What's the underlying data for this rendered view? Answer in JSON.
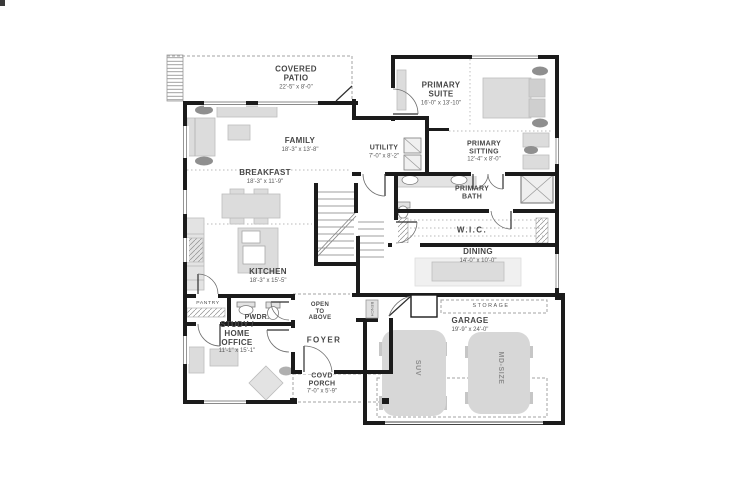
{
  "floor_plan": {
    "rooms": {
      "covered_patio": {
        "name": "COVERED PATIO",
        "dims": "22'-5\" x 8'-0\""
      },
      "family": {
        "name": "FAMILY",
        "dims": "18'-3\" x 13'-8\""
      },
      "primary_suite": {
        "name": "PRIMARY SUITE",
        "dims": "16'-0\" x 13'-10\""
      },
      "utility": {
        "name": "UTILITY",
        "dims": "7'-0\" x 8'-2\""
      },
      "primary_sitting": {
        "name": "PRIMARY SITTING",
        "dims": "12'-4\" x 8'-0\""
      },
      "breakfast": {
        "name": "BREAKFAST",
        "dims": "18'-3\" x 11'-9\""
      },
      "primary_bath": {
        "name": "PRIMARY BATH"
      },
      "wic": {
        "name": "W.I.C."
      },
      "dining": {
        "name": "DINING",
        "dims": "14'-0\" x 10'-0\""
      },
      "kitchen": {
        "name": "KITCHEN",
        "dims": "18'-3\" x 15'-5\""
      },
      "pantry": {
        "name": "PANTRY"
      },
      "powder": {
        "name": "PWDR."
      },
      "open_to_above": {
        "name": "OPEN TO ABOVE"
      },
      "study": {
        "name": "STUDY / HOME OFFICE",
        "dims": "11'-1\" x 15'-1\""
      },
      "foyer": {
        "name": "FOYER"
      },
      "covd_porch": {
        "name": "COVD PORCH",
        "dims": "7'-0\" x 5'-9\""
      },
      "garage": {
        "name": "GARAGE",
        "dims": "19'-9\" x 24'-0\""
      },
      "storage": {
        "name": "STORAGE"
      }
    },
    "annotations": {
      "suv": "SUV",
      "md_size": "MD-SIZE",
      "bench": "BENCH"
    },
    "colors": {
      "wall": "#1b1b1b",
      "furniture": "#dcdcdc",
      "text": "#474747",
      "dash": "#9b9b9b"
    }
  }
}
